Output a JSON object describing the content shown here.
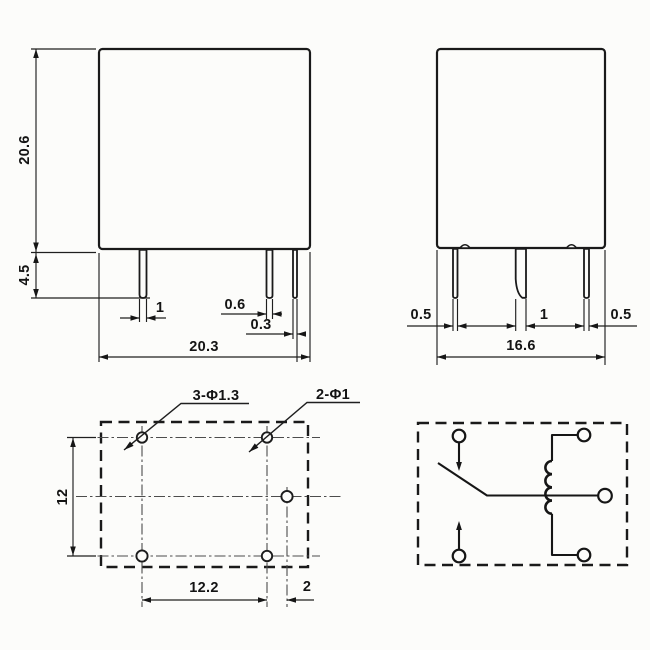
{
  "colors": {
    "line": "#1a1a1a",
    "background": "#fcfcfa"
  },
  "front_view": {
    "body_height": "20.6",
    "pin_length": "4.5",
    "coil_pin_width": "1",
    "contact_pin_width": "0.6",
    "contact_pin_gap": "0.3",
    "body_width": "20.3"
  },
  "side_view": {
    "left_pin_width": "0.5",
    "middle_pin_width": "1",
    "right_pin_width": "0.5",
    "body_depth": "16.6"
  },
  "bottom_view": {
    "mount_holes_label": "3-Φ1.3",
    "pin_holes_label": "2-Φ1",
    "row_pitch": "12",
    "column_pitch": "12.2",
    "common_pin_offset": "2"
  }
}
